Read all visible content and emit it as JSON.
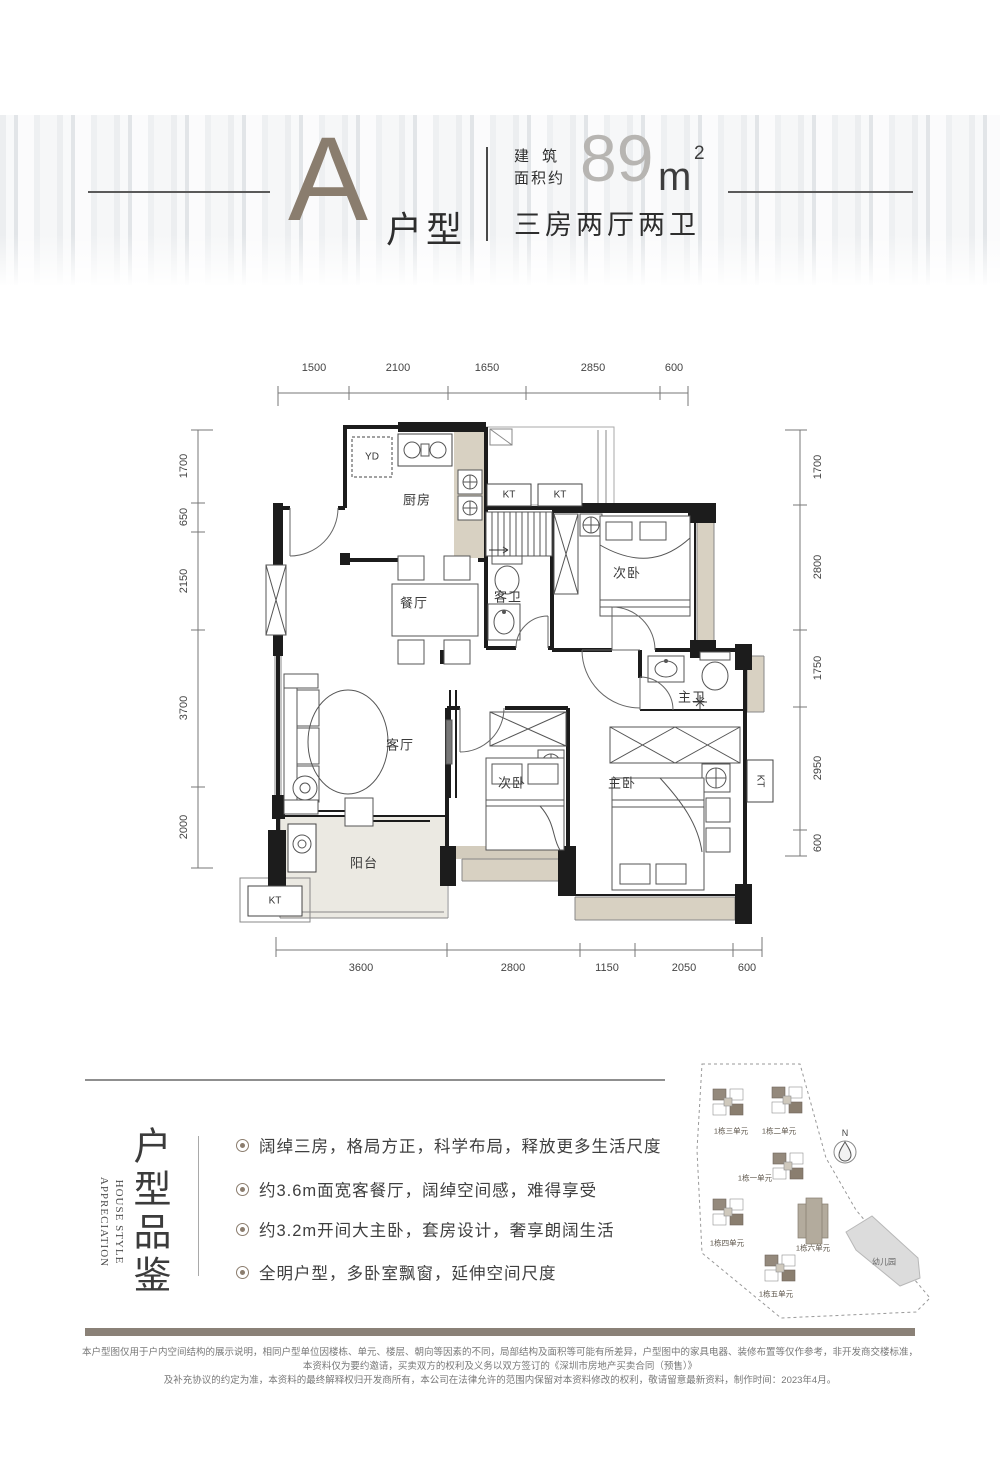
{
  "header": {
    "unit_letter": "A",
    "unit_suffix": "户型",
    "area_label_line1": "建筑",
    "area_label_line2": "面积约",
    "area_number": "89",
    "area_unit": "m",
    "area_sup": "2",
    "spec": "三房两厅两卫",
    "accent_color": "#8a7d6e"
  },
  "plan": {
    "dims_top": [
      "1500",
      "2100",
      "1650",
      "2850",
      "600"
    ],
    "dims_bottom": [
      "3600",
      "2800",
      "1150",
      "2050",
      "600"
    ],
    "dims_left": [
      "1700",
      "650",
      "2150",
      "3700",
      "2000"
    ],
    "dims_right": [
      "1700",
      "2800",
      "1750",
      "2950",
      "600"
    ],
    "rooms": {
      "kitchen": "厨房",
      "dining": "餐厅",
      "guest_bath": "客卫",
      "secondary_bedroom": "次卧",
      "living": "客厅",
      "master_bedroom": "主卧",
      "master_bath": "主卫",
      "balcony": "阳台",
      "kt": "KT",
      "yd": "YD"
    }
  },
  "features": {
    "en_line1": "HOUSE STYLE",
    "en_line2": "APPRECIATION",
    "cn_title": "户型品鉴",
    "bullets": [
      "阔绰三房，格局方正，科学布局，释放更多生活尺度",
      "约3.6m面宽客餐厅，阔绰空间感，难得享受",
      "约3.2m开间大主卧，套房设计，奢享朗阔生活",
      "全明户型，多卧室飘窗，延伸空间尺度"
    ]
  },
  "siteplan": {
    "buildings": [
      "1栋三单元",
      "1栋二单元",
      "1栋一单元",
      "1栋四单元",
      "1栋六单元",
      "1栋五单元"
    ],
    "kindergarten": "幼儿园",
    "north": "N"
  },
  "disclaimer": {
    "line1": "本户型图仅用于户内空间结构的展示说明，相同户型单位因楼栋、单元、楼层、朝向等因素的不同，局部结构及面积等可能有所差异，户型图中的家具电器、装修布置等仅作参考，非开发商交楼标准，本资料仅为要约邀请，买卖双方的权利及义务以双方签订的《深圳市房地产买卖合同（预售）》",
    "line2": "及补充协议的约定为准，本资料的最终解释权归开发商所有，本公司在法律允许的范围内保留对本资料修改的权利，敬请留意最新资料，制作时间：2023年4月。"
  }
}
